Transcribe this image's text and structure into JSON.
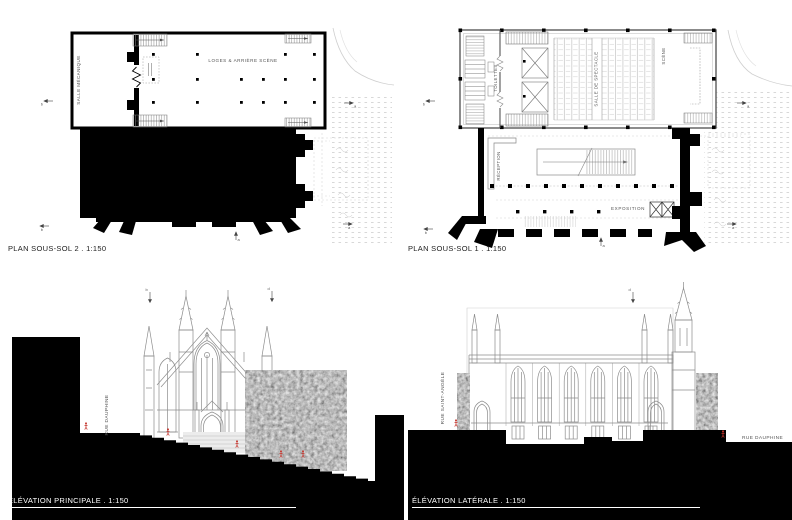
{
  "colors": {
    "ink": "#000000",
    "line": "#8a8a8a",
    "faint": "#c9c9c9",
    "red": "#c4332b",
    "paper": "#ffffff"
  },
  "panels": {
    "plan_sous_sol_2": {
      "caption": "PLAN SOUS-SOL 2 . 1:150",
      "labels": {
        "salle_mecanique": "SALLE MÉCANIQUE",
        "loges_arriere_scene": "LOGES & ARRIÈRE SCÈNE"
      },
      "markers": {
        "left": "b",
        "right": "a",
        "bottom_left": "b",
        "bottom_center": "a",
        "bottom_right": "a"
      }
    },
    "plan_sous_sol_1": {
      "caption": "PLAN SOUS-SOL 1 . 1:150",
      "labels": {
        "toilettes": "TOILETTES",
        "salle_de_spectacle": "SALLE DE SPECTACLE",
        "scene": "SCÈNE",
        "reception": "RÉCEPTION",
        "exposition": "EXPOSITION"
      },
      "markers": {
        "left": "b",
        "right": "a",
        "bottom_left": "b",
        "bottom_center": "a",
        "bottom_right": "a"
      }
    },
    "elevation_principale": {
      "caption": "ÉLÉVATION PRINCIPALE . 1:150",
      "labels": {
        "rue_dauphine": "RUE DAUPHINE"
      },
      "markers": {
        "top_left": "b",
        "top_right": "d"
      }
    },
    "elevation_laterale": {
      "caption": "ÉLÉVATION LATÉRALE . 1:150",
      "labels": {
        "rue_saint_angele": "RUE SAINT-ANGÈLE",
        "rue_dauphine": "RUE DAUPHINE"
      },
      "markers": {
        "top": "d"
      }
    }
  }
}
